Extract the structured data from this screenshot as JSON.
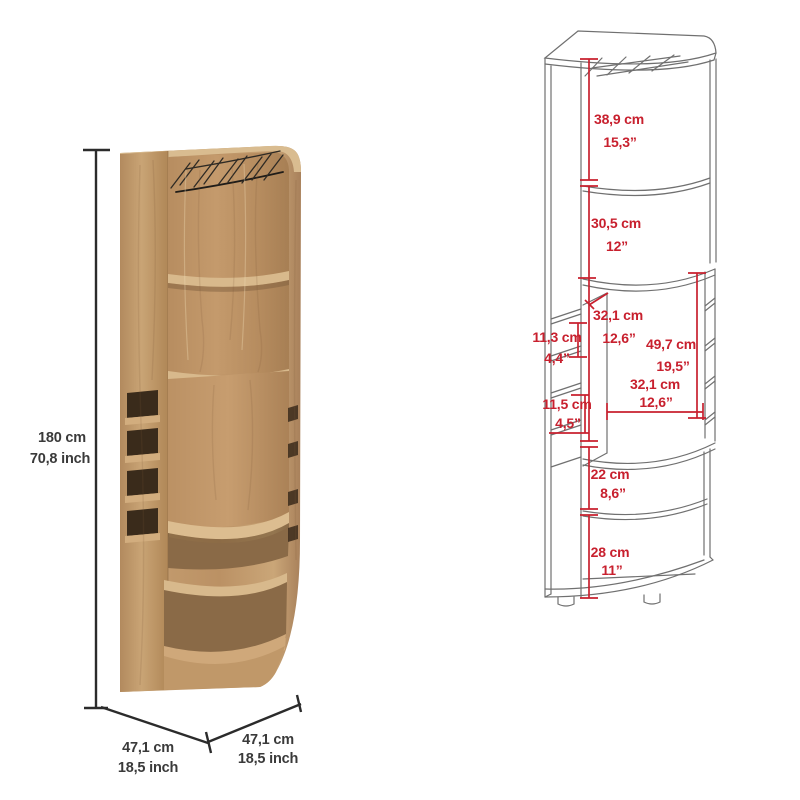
{
  "page": {
    "title": "Corner bar cabinet dimension sheet",
    "background": "#ffffff"
  },
  "colors": {
    "annotation_red": "#c8202e",
    "dimension_black": "#2b2b2b",
    "label_black": "#3a3a3a",
    "outline_gray": "#707070",
    "wood_light": "#d8b98c",
    "wood_mid": "#bf9468",
    "wood_dark": "#8a6743",
    "slot_dark": "#3a2b1b"
  },
  "photo": {
    "description": "corner bar cabinet, light oak finish, stemware rack and bottle cubbies",
    "height": {
      "cm": "180 cm",
      "inch": "70,8 inch"
    },
    "depth_left": {
      "cm": "47,1 cm",
      "inch": "18,5 inch"
    },
    "depth_right": {
      "cm": "47,1 cm",
      "inch": "18,5 inch"
    }
  },
  "diagram": {
    "description": "line drawing of corner bar cabinet with interior dimensions",
    "dims": {
      "top_section": {
        "cm": "38,9 cm",
        "inch": "15,3”"
      },
      "upper_shelf": {
        "cm": "30,5 cm",
        "inch": "12”"
      },
      "middle_top_width": {
        "cm": "32,1 cm",
        "inch": "12,6”"
      },
      "left_cubby": {
        "cm": "11,3 cm",
        "inch": "4,4”"
      },
      "middle_height": {
        "cm": "49,7 cm",
        "inch": "19,5”"
      },
      "middle_bottom_width": {
        "cm": "32,1 cm",
        "inch": "12,6”"
      },
      "lower_cubby": {
        "cm": "11,5 cm",
        "inch": "4,5”"
      },
      "lower_shelf": {
        "cm": "22 cm",
        "inch": "8,6”"
      },
      "bottom_section": {
        "cm": "28 cm",
        "inch": "11”"
      }
    }
  }
}
